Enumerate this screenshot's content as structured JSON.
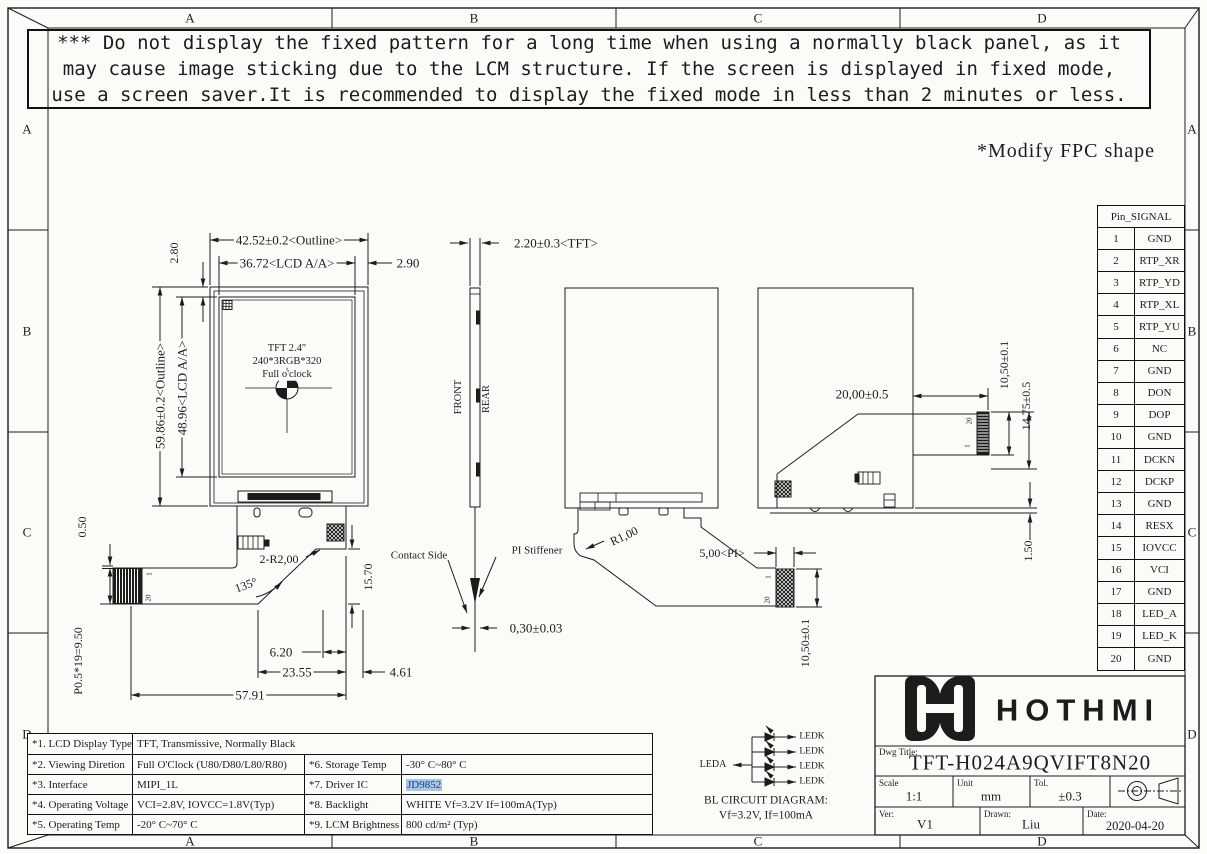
{
  "zones": {
    "cols": [
      "A",
      "B",
      "C",
      "D"
    ],
    "rows": [
      "A",
      "B",
      "C",
      "D"
    ]
  },
  "warning": {
    "lines": [
      "*** Do not display the fixed pattern for a long time when using a normally black panel, as it",
      "may cause image sticking due to the LCM structure. If the screen is displayed in fixed mode,",
      "use a screen saver.It is recommended to display the fixed mode in less than 2 minutes or less."
    ]
  },
  "note": "*Modify FPC shape",
  "front_view": {
    "screen_lines": [
      "TFT 2.4″",
      "240*3RGB*320",
      "Full o'clock"
    ],
    "dim_outline_w": "42.52±0.2<Outline>",
    "dim_aa_w": "36.72<LCD A/A>",
    "dim_right_margin": "2.90",
    "dim_top_margin": "2.80",
    "dim_outline_h": "59.86±0.2<Outline>",
    "dim_aa_h": "48.96<LCD A/A>",
    "dim_offset": "0.50",
    "dim_pitch": "P0.5*19=9.50",
    "dim_radius": "2-R2,00",
    "dim_angle": "135°",
    "dim_contact_h": "15.70",
    "label_contact_side": "Contact Side",
    "dim_620": "6.20",
    "dim_2355": "23.55",
    "dim_461": "4.61",
    "dim_5791": "57.91",
    "pin_first": "1",
    "pin_last": "20"
  },
  "side_view": {
    "dim_thickness": "2.20±0.3<TFT>",
    "label_front": "FRONT",
    "label_rear": "REAR",
    "label_pi": "PI Stiffener",
    "dim_fpc": "0,30±0.03"
  },
  "rear_view_1": {
    "dim_radius": "R1,00",
    "dim_pi": "5,00<PI>",
    "dim_conn": "10,50±0.1",
    "pin_first": "1",
    "pin_last": "20"
  },
  "rear_view_2": {
    "dim_20": "20,00±0.5",
    "dim_1050": "10,50±0.1",
    "dim_1475": "14,75±0.5",
    "dim_150": "1.50",
    "pin_first": "1",
    "pin_last": "20"
  },
  "pin_table": {
    "header": "Pin_SIGNAL",
    "pins": [
      [
        "1",
        "GND"
      ],
      [
        "2",
        "RTP_XR"
      ],
      [
        "3",
        "RTP_YD"
      ],
      [
        "4",
        "RTP_XL"
      ],
      [
        "5",
        "RTP_YU"
      ],
      [
        "6",
        "NC"
      ],
      [
        "7",
        "GND"
      ],
      [
        "8",
        "DON"
      ],
      [
        "9",
        "DOP"
      ],
      [
        "10",
        "GND"
      ],
      [
        "11",
        "DCKN"
      ],
      [
        "12",
        "DCKP"
      ],
      [
        "13",
        "GND"
      ],
      [
        "14",
        "RESX"
      ],
      [
        "15",
        "IOVCC"
      ],
      [
        "16",
        "VCI"
      ],
      [
        "17",
        "GND"
      ],
      [
        "18",
        "LED_A"
      ],
      [
        "19",
        "LED_K"
      ],
      [
        "20",
        "GND"
      ]
    ]
  },
  "spec_table": {
    "r1c1": "*1. LCD Display Type",
    "r1c2": "TFT, Transmissive, Normally Black",
    "r2c1": "*2. Viewing Diretion",
    "r2c2": "Full O'Clock (U80/D80/L80/R80)",
    "r2c3": "*6. Storage Temp",
    "r2c4": "-30° C~80° C",
    "r3c1": "*3. Interface",
    "r3c2": "MIPI_1L",
    "r3c3": "*7. Driver IC",
    "r3c4": "JD9852",
    "r4c1": "*4. Operating Voltage",
    "r4c2": "VCI=2.8V, IOVCC=1.8V(Typ)",
    "r4c3": "*8. Backlight",
    "r4c4": "WHITE Vf=3.2V If=100mA(Typ)",
    "r5c1": "*5. Operating Temp",
    "r5c2": "-20° C~70° C",
    "r5c3": "*9. LCM Brightness",
    "r5c4": "800 cd/m² (Typ)"
  },
  "bl_circuit": {
    "label_leda": "LEDA",
    "label_ledk": "LEDK",
    "title": "BL CIRCUIT DIAGRAM:",
    "subtitle": "Vf=3.2V, If=100mA"
  },
  "title_block": {
    "brand": "HOTHMI",
    "dwg_title_label": "Dwg Title:",
    "dwg_title": "TFT-H024A9QVIFT8N20",
    "scale_label": "Scale",
    "scale_value": "1:1",
    "unit_label": "Unit",
    "unit_value": "mm",
    "tol_label": "Tol.",
    "tol_value": "±0.3",
    "ver_label": "Ver:",
    "ver_value": "V1",
    "drawn_label": "Drawn:",
    "drawn_value": "Liu",
    "date_label": "Date:",
    "date_value": "2020-04-20"
  },
  "colors": {
    "line": "#1c1c1c",
    "highlight_bg": "#a7c7e7",
    "highlight_text": "#1f3f77"
  }
}
